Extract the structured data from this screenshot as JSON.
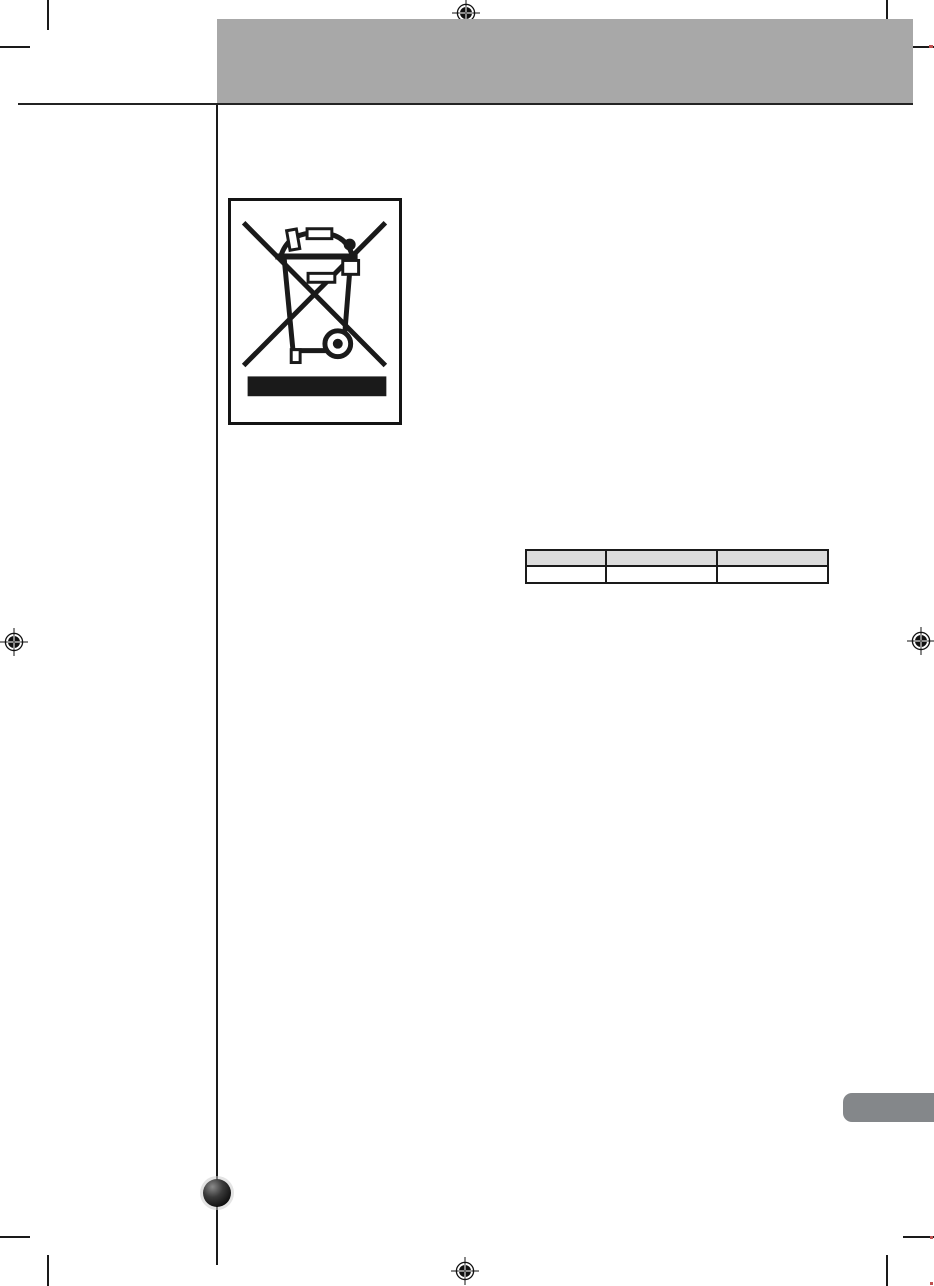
{
  "document": {
    "kind": "printed-manual-page-proof",
    "background_color": "#ffffff",
    "ink_color": "#1a1a1a"
  },
  "header": {
    "banner_color": "#a8a8a8",
    "banner_underline_color": "#232323",
    "title_text": ""
  },
  "margin": {
    "left_rule_color": "#232323",
    "vertical_rule_color": "#1a1a1a"
  },
  "weee_symbol": {
    "name": "crossed-out-wheeled-bin",
    "meaning_icon": "weee-disposal-icon",
    "box_border_color": "#141414",
    "ink_color": "#1a1a1a",
    "bar_color": "#1a1a1a",
    "fill_color": "#ffffff"
  },
  "table": {
    "columns": 3,
    "header_fill": "#dcdcdc",
    "body_fill": "#ffffff",
    "border_color": "#1a1a1a",
    "header_cells": [
      "",
      "",
      ""
    ],
    "body_cells": [
      "",
      "",
      ""
    ]
  },
  "side_tab": {
    "color": "#84878a",
    "label": ""
  },
  "sphere_bullet": {
    "core_color": "#111111",
    "highlight_color": "#8a8a8a",
    "halo_color": "#cdcdcd"
  },
  "print_marks": {
    "crop_mark_color": "#1a1a1a",
    "registration_mark_color": "#111111",
    "red_accent_color": "#c05050"
  }
}
